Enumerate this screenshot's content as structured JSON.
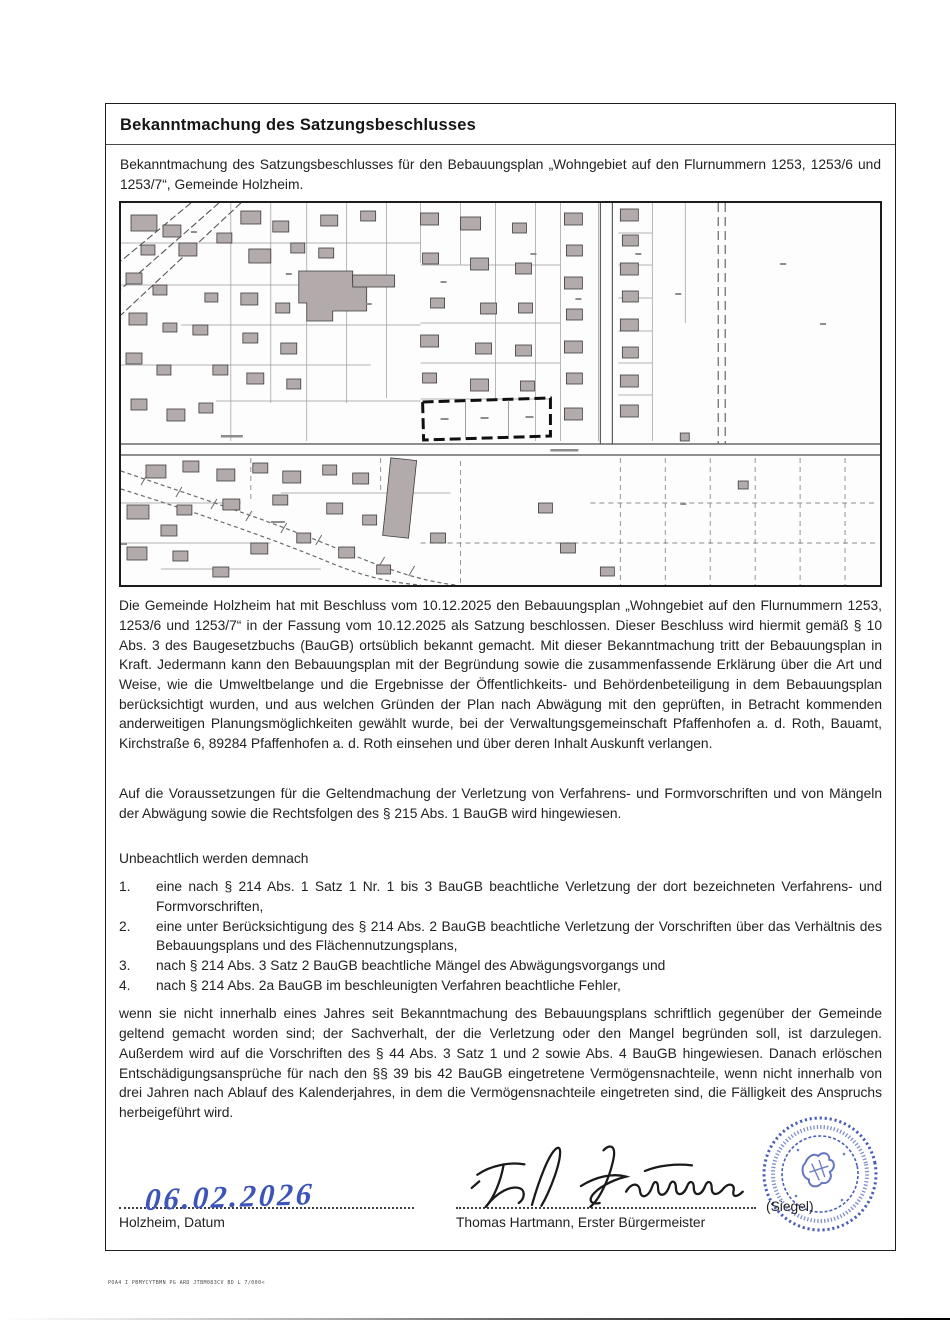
{
  "document": {
    "title": "Bekanntmachung des Satzungsbeschlusses",
    "intro": "Bekanntmachung des Satzungsbeschlusses für den Bebauungsplan „Wohngebiet auf den Flurnummern 1253, 1253/6 und 1253/7“, Gemeinde Holzheim.",
    "body_paragraphs": [
      "Die Gemeinde Holzheim hat mit Beschluss vom 10.12.2025 den Bebauungsplan „Wohngebiet auf den Flurnummern 1253, 1253/6 und 1253/7“ in der Fassung vom 10.12.2025 als Satzung beschlossen. Dieser Beschluss wird hiermit gemäß § 10 Abs. 3 des Baugesetzbuchs (BauGB) ortsüblich bekannt gemacht. Mit dieser Bekanntmachung tritt der Bebauungsplan in Kraft. Jedermann kann den Bebauungsplan mit der Begründung sowie die zusammenfassende Erklärung über die Art und Weise, wie die Umweltbelange und die Ergebnisse der Öffentlichkeits- und Behördenbeteiligung in dem Bebauungsplan berücksichtigt wurden, und aus welchen Gründen der Plan nach Abwägung mit den geprüften, in Betracht kommenden anderweitigen Planungsmöglichkeiten gewählt wurde, bei der Verwaltungsgemeinschaft Pfaffenhofen a. d. Roth, Bauamt, Kirchstraße 6, 89284 Pfaffenhofen a. d. Roth einsehen und über deren Inhalt Auskunft verlangen.",
      "Auf die Voraussetzungen für die Geltendmachung der Verletzung von Verfahrens- und Formvorschriften und von Mängeln der Abwägung sowie die Rechtsfolgen des § 215 Abs. 1 BauGB wird hingewiesen."
    ],
    "list": {
      "intro": "Unbeachtlich werden demnach",
      "items": [
        {
          "num": "1.",
          "text": "eine nach § 214 Abs. 1 Satz 1 Nr. 1 bis 3 BauGB beachtliche Verletzung der dort bezeichneten Verfahrens- und Formvorschriften,"
        },
        {
          "num": "2.",
          "text": "eine unter Berücksichtigung des § 214 Abs. 2 BauGB beachtliche Verletzung der Vorschriften über das Verhältnis des Bebauungsplans und des Flächennutzungsplans,"
        },
        {
          "num": "3.",
          "text": "nach § 214 Abs. 3 Satz 2 BauGB beachtliche Mängel des Abwägungsvorgangs und"
        },
        {
          "num": "4.",
          "text": "nach § 214 Abs. 2a BauGB im beschleunigten Verfahren beachtliche Fehler,"
        }
      ]
    },
    "closing": "wenn sie nicht innerhalb eines Jahres seit Bekanntmachung des Bebauungsplans schriftlich gegenüber der Gemeinde geltend gemacht worden sind; der Sachverhalt, der die Verletzung oder den Mangel begründen soll, ist darzulegen. Außerdem wird auf die Vorschriften des § 44 Abs. 3 Satz 1 und 2 sowie Abs. 4 BauGB hingewiesen. Danach erlöschen Entschädigungsansprüche für nach den §§ 39 bis 42 BauGB eingetretene Vermögensnachteile, wenn nicht innerhalb von drei Jahren nach Ablauf des Kalenderjahres, in dem die Vermögensnachteile eingetreten sind, die Fälligkeit des Anspruchs herbeigeführt wird.",
    "signature": {
      "date_value": "06.02.2026",
      "date_label": "Holzheim, Datum",
      "signer_label": "Thomas Hartmann, Erster Bürgermeister",
      "seal_label": "(Siegel)"
    },
    "footer_reference": "POA4 I PBMYCYTBMN PG ARD JTBM083CV BD L 7/000<",
    "icons": {
      "municipal-seal": "blue circular ink stamp",
      "signature-script": "handwritten signature Th. Hartmann",
      "date-script": "handwritten blue date"
    },
    "colors": {
      "seal_blue": "#3a50b2",
      "handwriting_blue": "#3d55b8",
      "border_black": "#1f1f1f"
    }
  }
}
